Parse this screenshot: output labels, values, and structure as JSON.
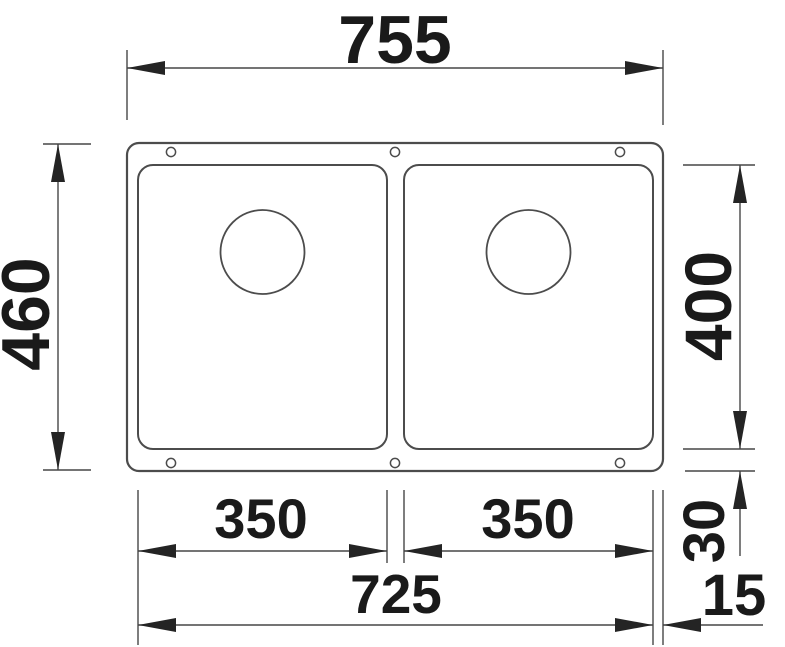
{
  "drawing": {
    "colors": {
      "background": "#ffffff",
      "line": "#4c4c4c",
      "dimension_line": "#474747",
      "text": "#1a1a1a",
      "arrow": "#242424"
    },
    "dimensions": {
      "overall_width": "755",
      "overall_depth": "460",
      "bowl_depth": "400",
      "left_bowl_width": "350",
      "right_bowl_width": "350",
      "bowls_overall_width": "725",
      "rim_depth": "30",
      "rim_side": "15"
    }
  }
}
